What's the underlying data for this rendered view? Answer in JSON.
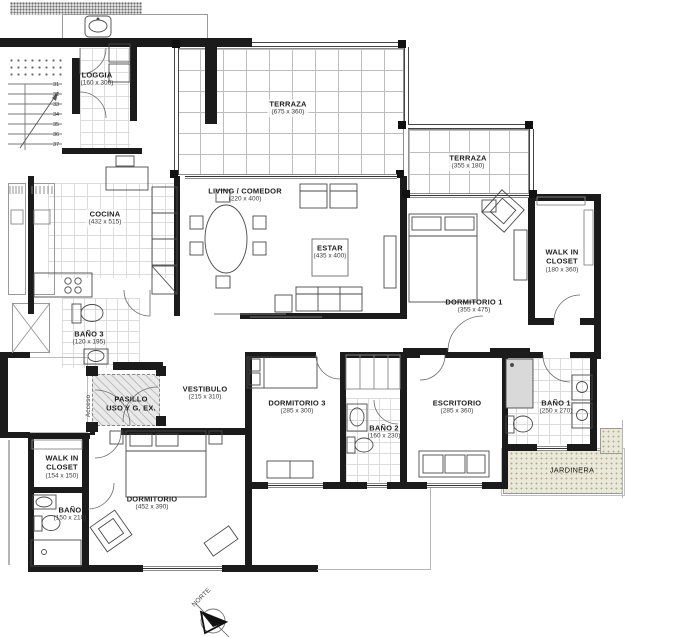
{
  "rooms": {
    "loggia": {
      "name": "LOGGIA",
      "dims": "(160 x 300)"
    },
    "terraza1": {
      "name": "TERRAZA",
      "dims": "(675 x 360)"
    },
    "terraza2": {
      "name": "TERRAZA",
      "dims": "(355 x 180)"
    },
    "living": {
      "name": "LIVING / COMEDOR",
      "dims": "(220 x 400)"
    },
    "estar": {
      "name": "ESTAR",
      "dims": "(435 x 400)"
    },
    "cocina": {
      "name": "COCINA",
      "dims": "(432 x 515)"
    },
    "bano3": {
      "name": "BAÑO 3",
      "dims": "(120 x 195)"
    },
    "pasillo": {
      "name": "PASILLO",
      "name2": "USO Y G. EX."
    },
    "vestibulo": {
      "name": "VESTIBULO",
      "dims": "(215 x 310)"
    },
    "dormitorio1": {
      "name": "DORMITORIO 1",
      "dims": "(355 x 475)"
    },
    "walkincloset1": {
      "name": "WALK IN",
      "name2": "CLOSET",
      "dims": "(180 x 360)"
    },
    "dormitorio3": {
      "name": "DORMITORIO 3",
      "dims": "(285 x 300)"
    },
    "bano2": {
      "name": "BAÑO 2",
      "dims": "(160 x 230)"
    },
    "escritorio": {
      "name": "ESCRITORIO",
      "dims": "(285 x 360)"
    },
    "bano1": {
      "name": "BAÑO 1",
      "dims": "(250 x 270)"
    },
    "jardinera": {
      "name": "JARDINERA"
    },
    "walkincloset2": {
      "name": "WALK IN",
      "name2": "CLOSET",
      "dims": "(154 x 150)"
    },
    "banoppl": {
      "name": "BAÑO",
      "dims": "(150 x 210)"
    },
    "dormitorio2": {
      "name": "DORMITORIO",
      "dims": "(452 x 390)"
    }
  },
  "annotations": {
    "acceso": "Acceso",
    "norte": "NORTE"
  },
  "stairs": [
    "31",
    "32",
    "33",
    "34",
    "35",
    "36",
    "37"
  ],
  "colors": {
    "wall": "#1b1b1b",
    "line": "#555555",
    "jardinera_bg": "#eae8d8",
    "hatch_bg": "#e9e9e9"
  }
}
